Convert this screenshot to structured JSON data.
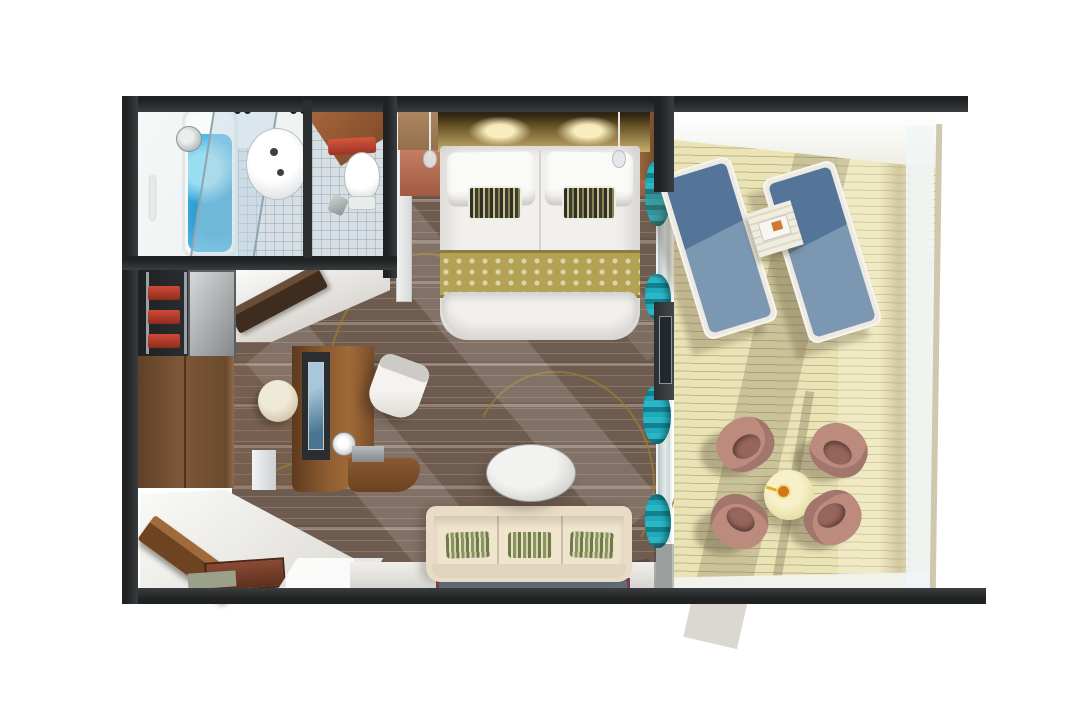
{
  "scene": {
    "width": 1067,
    "height": 711,
    "background": "#ffffff",
    "description": "3D top-down cutaway floor plan rendering of a suite with bathroom, toilet room, closet, bedroom, desk area, living area and a private balcony with loungers and a dining set"
  },
  "palette": {
    "wall": "#2e3132",
    "carpet": "#6f5c50",
    "vine": "#9a7d33",
    "tile": "#d7dfe5",
    "water": "#4db7e4",
    "whiteFixture": "#fafbfb",
    "bedWhite": "#f2f0ec",
    "runner": "#b3a254",
    "sofa": "#e8dcc6",
    "rugBlue": "#5f6f7c",
    "rugBorder": "#7a3f52",
    "deck": "#e9e3b6",
    "frameWhite": "#eceae2",
    "pinkChair": "#bd8a7e",
    "pinkChairDark": "#96655c",
    "railFrame": "#cfc7ae",
    "teal": "#1fa9ba",
    "terracotta": "#b4705a",
    "woodDark": "#6b4a2e",
    "lightStreak": "rgba(255,255,255,0.13)"
  },
  "rooms": {
    "bathroom": {
      "label": "Bathroom with tub, shower glass and basin"
    },
    "wc": {
      "label": "Toilet room"
    },
    "closet": {
      "label": "Closet with shelves and towels"
    },
    "corridor": {
      "label": "Corridor"
    },
    "bedroom": {
      "label": "Bedroom with double bed"
    },
    "desk_area": {
      "label": "Desk and vanity area"
    },
    "living": {
      "label": "Living area with sofa"
    },
    "entry": {
      "label": "Entry with open door"
    },
    "balcony": {
      "label": "Private balcony"
    }
  },
  "furniture": {
    "bed": {
      "label": "Double bed with gold runner and accent pillows"
    },
    "headboard": {
      "label": "Backlit wooden headboard"
    },
    "nightstands": {
      "label": "Terracotta nightstands with pendant lamps"
    },
    "sofa": {
      "label": "Cream three-seat sofa with striped pillows"
    },
    "coffee_table": {
      "label": "Oval coffee table"
    },
    "rug": {
      "label": "Blue rug with maroon border"
    },
    "desk": {
      "label": "Curved wooden desk with TV panel and lamp"
    },
    "desk_chair": {
      "label": "White desk chair"
    },
    "stool": {
      "label": "Round stool"
    },
    "wardrobe": {
      "label": "Wooden wardrobe"
    },
    "tub": {
      "label": "Bathtub with water"
    },
    "sink": {
      "label": "Round basin"
    },
    "toilet": {
      "label": "Toilet"
    },
    "curtains": {
      "label": "Teal curtains at balcony doors"
    },
    "loungers": {
      "label": "Two blue sun loungers"
    },
    "side_table": {
      "label": "Slatted side table with book"
    },
    "dining_table": {
      "label": "Round balcony table with drink"
    },
    "dining_chairs": {
      "label": "Four rose balcony chairs"
    },
    "railing": {
      "label": "Glass balcony railing"
    }
  }
}
